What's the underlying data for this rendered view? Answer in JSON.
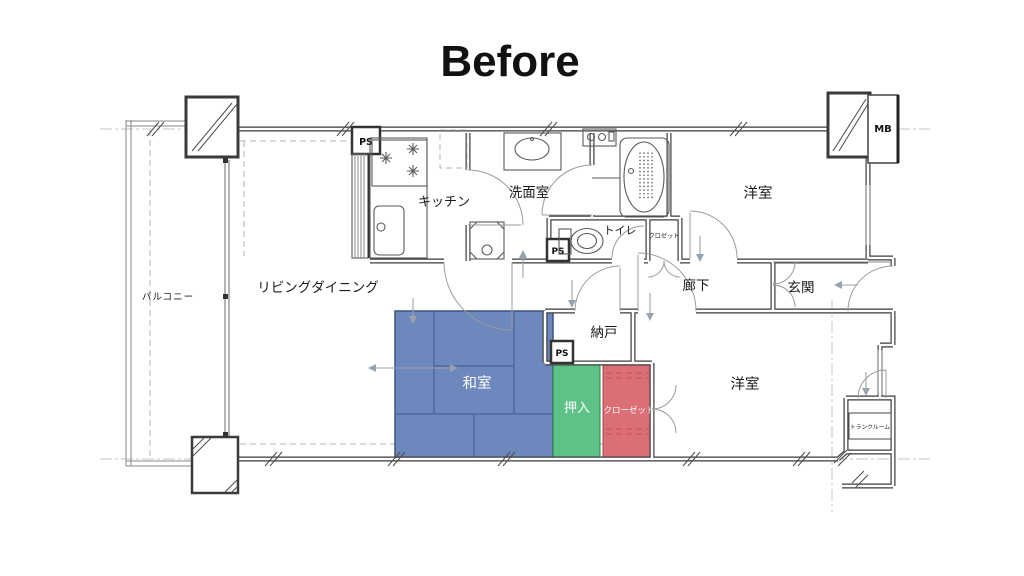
{
  "title": "Before",
  "colors": {
    "washitsu": "#6d88bc",
    "oshiire": "#5ec287",
    "closet": "#dc6e76"
  },
  "rooms": {
    "balcony": {
      "label": "バルコニー"
    },
    "living_dining": {
      "label": "リビングダイニング"
    },
    "kitchen": {
      "label": "キッチン"
    },
    "washroom": {
      "label": "洗面室"
    },
    "toilet": {
      "label": "トイレ"
    },
    "hall_closet": {
      "label": "クロゼット"
    },
    "bedroom_north": {
      "label": "洋室"
    },
    "corridor": {
      "label": "廊下"
    },
    "entrance": {
      "label": "玄関"
    },
    "storage_room": {
      "label": "納戸"
    },
    "japanese_room": {
      "label": "和室"
    },
    "oshiire": {
      "label": "押入"
    },
    "closet": {
      "label": "クローゼット"
    },
    "bedroom_south": {
      "label": "洋室"
    },
    "trunk_room": {
      "label": "トランクルーム"
    }
  },
  "badges": {
    "ps": "PS",
    "mb": "MB"
  }
}
